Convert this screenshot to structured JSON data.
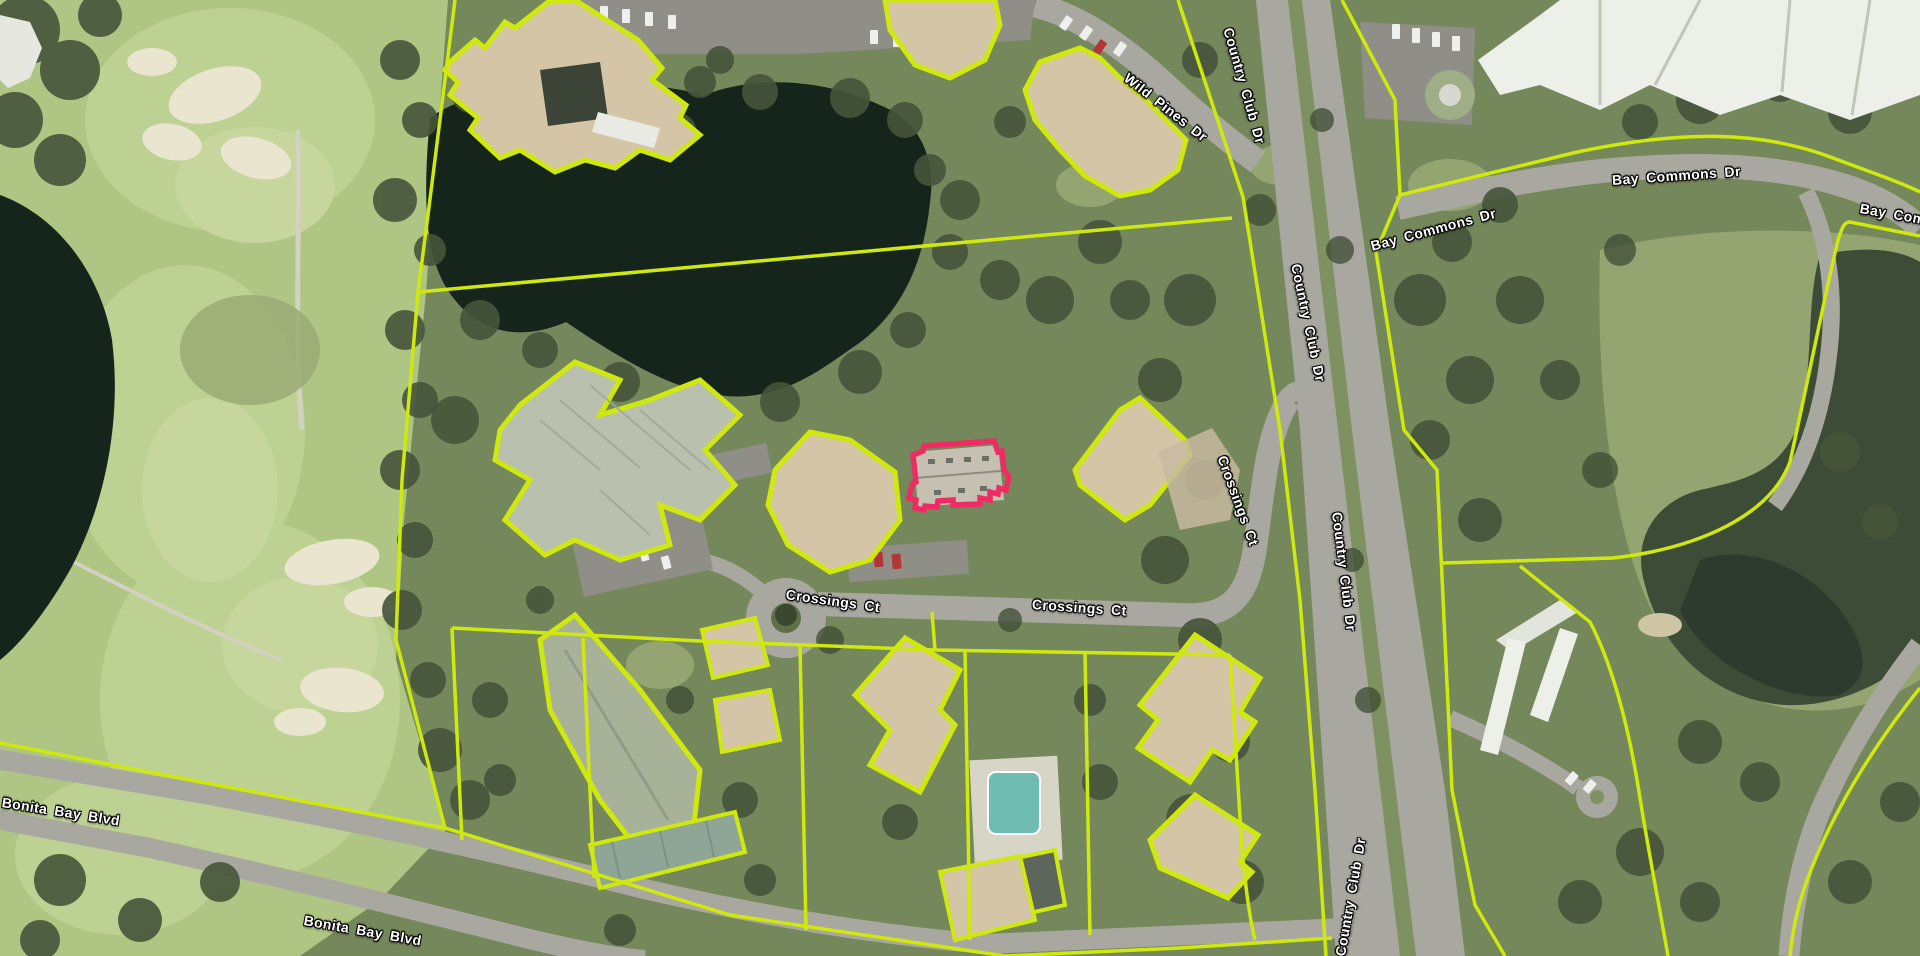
{
  "map": {
    "type": "aerial-parcel-map",
    "selected_parcel": {
      "outline_color": "#ee2b63"
    }
  },
  "street_labels": [
    {
      "text": "Wild Pines Dr",
      "x": 1126,
      "y": 68,
      "rot": 38
    },
    {
      "text": "Country Club Dr",
      "x": 1228,
      "y": 20,
      "rot": 74
    },
    {
      "text": "Country Club Dr",
      "x": 1296,
      "y": 256,
      "rot": 78
    },
    {
      "text": "Bay Commons Dr",
      "x": 1371,
      "y": 238,
      "rot": -15
    },
    {
      "text": "Bay Commons Dr",
      "x": 1612,
      "y": 172,
      "rot": -4
    },
    {
      "text": "Bay Com",
      "x": 1860,
      "y": 200,
      "rot": 10
    },
    {
      "text": "Crossings Ct",
      "x": 786,
      "y": 586,
      "rot": 8
    },
    {
      "text": "Crossings Ct",
      "x": 1032,
      "y": 596,
      "rot": 4
    },
    {
      "text": "Crossings Ct",
      "x": 1222,
      "y": 448,
      "rot": 70
    },
    {
      "text": "Country Club Dr",
      "x": 1337,
      "y": 504,
      "rot": 83
    },
    {
      "text": "Country Club Dr",
      "x": 1340,
      "y": 948,
      "rot": -80
    },
    {
      "text": "Bonita Bay Blvd",
      "x": 2,
      "y": 794,
      "rot": 9
    },
    {
      "text": "Bonita Bay Blvd",
      "x": 304,
      "y": 912,
      "rot": 10
    }
  ],
  "colors": {
    "parcel_line": "#cfe90f",
    "selected_parcel": "#ee2b63",
    "water_dark": "#16251c",
    "water_pond": "#3c4c36",
    "road": "#a8a8a0",
    "road_dark": "#8f8f87",
    "golf_light": "#aec583",
    "fairway": "#bdd193",
    "veg_base": "#75885c",
    "veg_light": "#9aaa74",
    "tree_dark": "#46543a",
    "tree_darker": "#3a4830",
    "roof_tan": "#d4c5a6",
    "roof_gray": "#b9c0ad",
    "roof_white": "#edefe9",
    "sand": "#e9e5cf",
    "pool": "#6fbcb2",
    "median_green": "#7e9160",
    "label_text": "#ffffff"
  }
}
